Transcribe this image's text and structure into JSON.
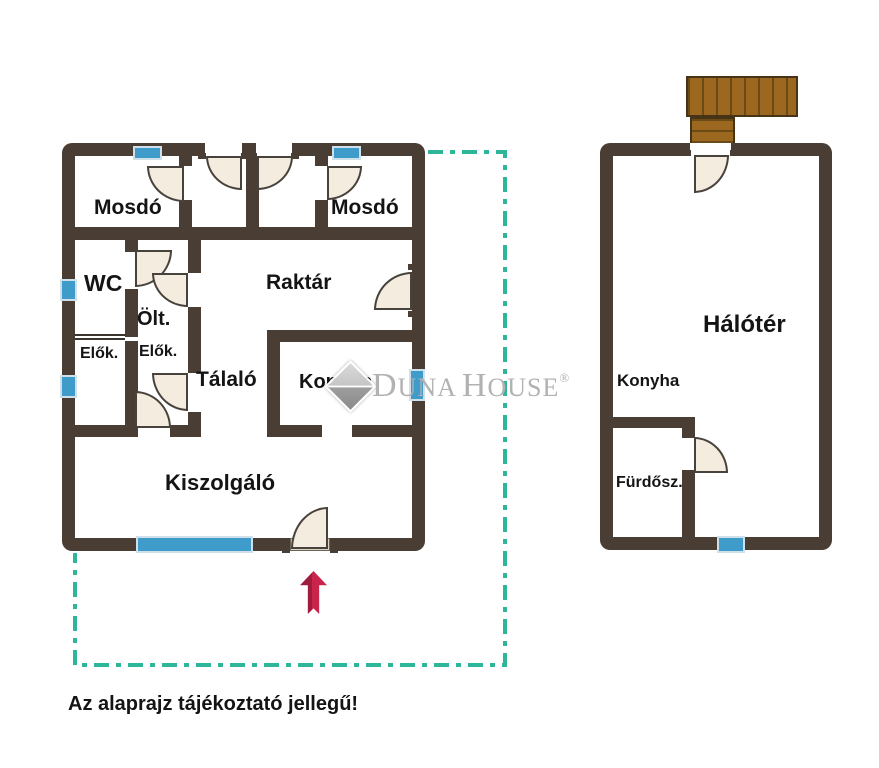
{
  "colors": {
    "wall": "#4a3d33",
    "window": "#3e9bca",
    "windowFrame": "#cfe0ea",
    "door": "#f4ecdf",
    "doorStroke": "#47423b",
    "deck": "#9c671e",
    "deckLine": "#6a4b15",
    "deckBorder": "#473418",
    "dash": "#2db69a",
    "arrow": "#c9244c",
    "arrowShade": "#9f1c3c",
    "watermark": "#b2b2b2",
    "text": "#141414",
    "threshold": "#ddd2c2"
  },
  "floorplan": {
    "left_building": {
      "rooms": [
        {
          "id": "mosdo-left",
          "label": "Mosdó"
        },
        {
          "id": "mosdo-right",
          "label": "Mosdó"
        },
        {
          "id": "wc",
          "label": "WC"
        },
        {
          "id": "olt",
          "label": "Ölt."
        },
        {
          "id": "elok-left",
          "label": "Elők."
        },
        {
          "id": "elok-right",
          "label": "Elők."
        },
        {
          "id": "raktar",
          "label": "Raktár"
        },
        {
          "id": "talalo",
          "label": "Tálaló"
        },
        {
          "id": "konyha",
          "label": "Konyha"
        },
        {
          "id": "kiszolgalo",
          "label": "Kiszolgáló"
        }
      ]
    },
    "right_building": {
      "rooms": [
        {
          "id": "haloter",
          "label": "Hálótér"
        },
        {
          "id": "konyha",
          "label": "Konyha"
        },
        {
          "id": "furdosz",
          "label": "Fürdősz."
        }
      ]
    }
  },
  "watermark": {
    "brand_first": "D",
    "brand_rest1": "UNA",
    "brand_second": "H",
    "brand_rest2": "OUSE",
    "registered": "®"
  },
  "footer": {
    "disclaimer": "Az alaprajz tájékoztató jellegű!"
  }
}
